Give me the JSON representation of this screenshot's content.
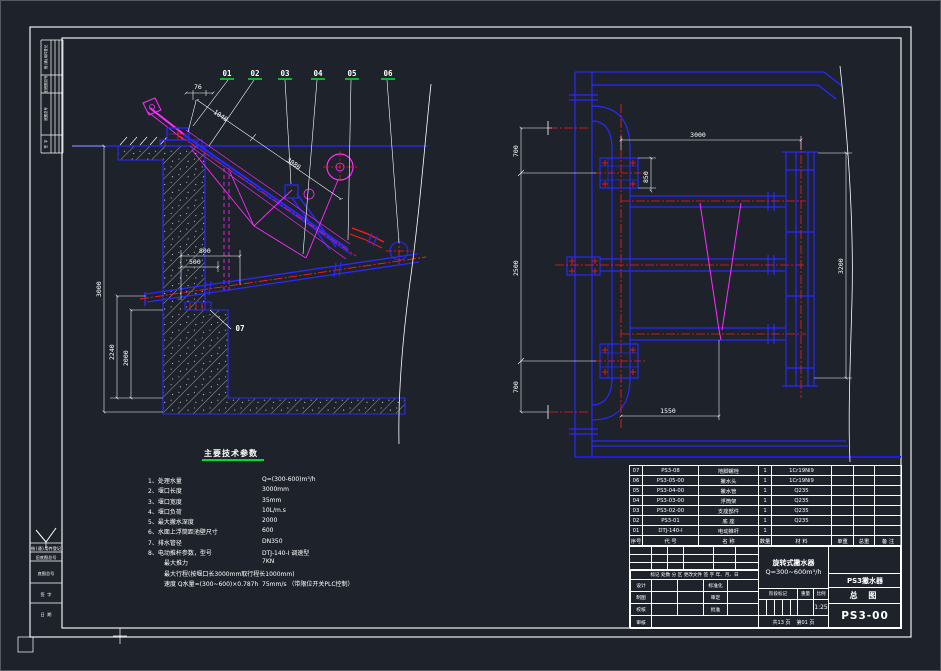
{
  "colors": {
    "background": "#1e232b",
    "line_blue": "#2929ff",
    "line_red": "#ff1a1a",
    "line_magenta": "#ff2bff",
    "line_white": "#ffffff",
    "accent_green": "#00dc32"
  },
  "lv": {
    "balloons": [
      "01",
      "02",
      "03",
      "04",
      "05",
      "06"
    ],
    "pier_balloon": "07",
    "d76": "76",
    "d1040": "1040",
    "d3080": "3080",
    "d800": "800",
    "d500": "500",
    "d3000": "3000",
    "d2240": "2240",
    "d2000": "2000"
  },
  "rv": {
    "d3000": "3000",
    "d700a": "700",
    "d2500": "2500",
    "d700b": "700",
    "d850": "850",
    "d3200": "3200",
    "d1550": "1550"
  },
  "specs": {
    "title": "主要技术参数",
    "items": [
      {
        "no": "1、",
        "label": "处理水量",
        "value": "Q=(300-600)m³/h"
      },
      {
        "no": "2、",
        "label": "堰口长度",
        "value": "3000mm"
      },
      {
        "no": "3、",
        "label": "堰口宽度",
        "value": "35mm"
      },
      {
        "no": "4、",
        "label": "堰口负荷",
        "value": "10L/m.s"
      },
      {
        "no": "5、",
        "label": "最大撇水深度",
        "value": "2000"
      },
      {
        "no": "6、",
        "label": "水面上浮筒距池壁尺寸",
        "value": "600"
      },
      {
        "no": "7、",
        "label": "排水管径",
        "value": "DN350"
      },
      {
        "no": "8、",
        "label": "电动推杆参数，型号",
        "value": "DTJ-140-Ⅰ  调速型"
      }
    ],
    "sub": [
      {
        "label": "最大推力",
        "value": "7KN"
      },
      {
        "label": "最大行程(按堰口长3000mm取行程长1000mm)",
        "value": ""
      },
      {
        "label": "速度 Q水量=(300~600)×0.787h",
        "value": "75mm/s （带限位开关PLC控制）"
      }
    ]
  },
  "bom": {
    "headers": [
      "序号",
      "代  号",
      "名    称",
      "数量",
      "材    料",
      "单重",
      "总重",
      "备 注"
    ],
    "rows": [
      {
        "no": "07",
        "code": "PS3-08",
        "name": "地脚螺栓",
        "qty": "1",
        "material": "1Cr19Ni9"
      },
      {
        "no": "06",
        "code": "PS3-05-00",
        "name": "撇水头",
        "qty": "1",
        "material": "1Cr19Ni9"
      },
      {
        "no": "05",
        "code": "PS3-04-00",
        "name": "撇水管",
        "qty": "1",
        "material": "Q235"
      },
      {
        "no": "04",
        "code": "PS3-03-00",
        "name": "浮筒架",
        "qty": "1",
        "material": "Q235"
      },
      {
        "no": "03",
        "code": "PS3-02-00",
        "name": "支座部件",
        "qty": "1",
        "material": "Q235"
      },
      {
        "no": "02",
        "code": "PS3-01",
        "name": "底  座",
        "qty": "1",
        "material": "Q235"
      },
      {
        "no": "01",
        "code": "DTJ-140-Ⅰ",
        "name": "电动推杆",
        "qty": "1",
        "material": ""
      }
    ]
  },
  "titleblock": {
    "product_line1": "旋转式撇水器",
    "product_line2": "Q=300~600m³/h",
    "model": "PS3撇水器",
    "sheet_title": "总  图",
    "drawing_no": "PS3-00",
    "scale_value": "1:25",
    "stage": [
      "阶段标记",
      "重量",
      "比例"
    ],
    "pages_total": "共13 页",
    "pages_no": "第01 页",
    "rev_row": "标记 处数 分 区  更改文件 签 字 年、月、日",
    "roles_left": [
      "设计",
      "制图",
      "校核",
      "审核"
    ],
    "roles_right": [
      "标准化",
      "审定",
      "批准"
    ]
  },
  "strips": {
    "top": [
      "借(通)用件登记",
      "旧底图总号",
      "底图总号",
      "签 字"
    ],
    "bottom": [
      "借(通)用件登记",
      "旧底图总号",
      "底图总号",
      "签  字",
      "日  期"
    ]
  }
}
